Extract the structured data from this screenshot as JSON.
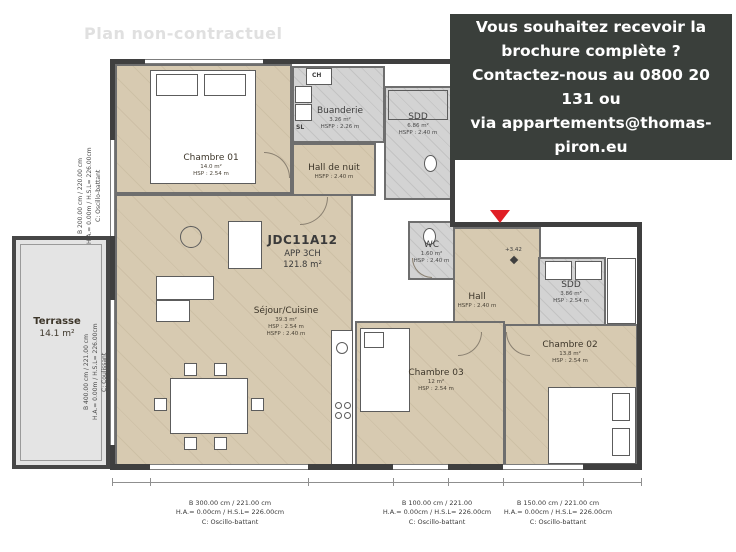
{
  "watermark": "Plan non-contractuel",
  "banner": {
    "bg": "#3a3f3b",
    "text": "Vous souhaitez recevoir la\nbrochure complète ?\nContactez-nous au 0800 20 131 ou\nvia appartements@thomas-\npiron.eu"
  },
  "unit": {
    "code": "JDC11A12",
    "type": "APP 3CH",
    "area": "121.8 m²"
  },
  "rooms": {
    "chambre01": {
      "name": "Chambre 01",
      "area": "14.0 m²",
      "height": "HSP : 2.54 m"
    },
    "buanderie": {
      "name": "Buanderie",
      "area": "3.26 m²",
      "height": "HSFP : 2.26 m"
    },
    "sdd1": {
      "name": "SDD",
      "area": "6.86 m²",
      "height": "HSFP : 2.40 m"
    },
    "hall_nuit": {
      "name": "Hall de nuit",
      "height": "HSFP : 2.40 m"
    },
    "wc": {
      "name": "WC",
      "area": "1.60 m²",
      "height": "HSP : 2.40 m"
    },
    "hall": {
      "name": "Hall",
      "height": "HSFP : 2.40 m"
    },
    "sdd2": {
      "name": "SDD",
      "area": "3.86 m²",
      "height": "HSP : 2.54 m"
    },
    "chambre02": {
      "name": "Chambre 02",
      "area": "13.8 m²",
      "height": "HSP : 2.54 m"
    },
    "chambre03": {
      "name": "Chambre 03",
      "area": "12 m²",
      "height": "HSP : 2.54 m"
    },
    "sejour": {
      "name": "Séjour/Cuisine",
      "area": "39.3 m²",
      "height": "HSP : 2.54 m",
      "height2": "HSFP : 2.40 m"
    },
    "terrasse": {
      "name": "Terrasse",
      "area": "14.1 m²"
    }
  },
  "small_labels": {
    "ch": "CH",
    "sl": "SL",
    "level": "+3.42"
  },
  "dims_bottom": [
    {
      "l1": "B 300.00 cm / 221.00 cm",
      "l2": "H.A.= 0.00cm / H.S.L= 226.00cm",
      "l3": "C: Oscillo-battant"
    },
    {
      "l1": "B 100.00 cm / 221.00",
      "l2": "H.A.= 0.00cm / H.S.L= 226.00cm",
      "l3": "C: Oscillo-battant"
    },
    {
      "l1": "B 150.00 cm / 221.00 cm",
      "l2": "H.A.= 0.00cm / H.S.L= 226.00cm",
      "l3": "C: Oscillo-battant"
    }
  ],
  "dims_left": [
    {
      "text": "B 200.00 cm / 220.00 cm\nH.A.= 0.00m / H.S.L= 226.00cm\nC: Oscillo-battant"
    },
    {
      "text": "B 400.00 cm / 221.00 cm\nH.A.= 0.00m / H.S.L= 226.00cm\nC: Coulissant"
    }
  ],
  "colors": {
    "accent_red": "#e01e25",
    "banner_bg": "#3a3f3b",
    "floor_beige": "#d7cab1",
    "floor_gray": "#d3d3d3"
  }
}
